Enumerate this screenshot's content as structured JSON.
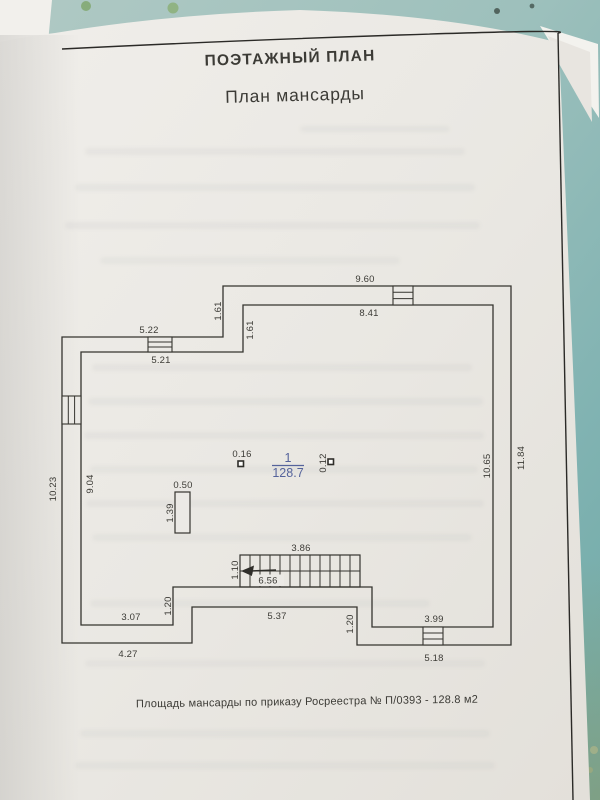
{
  "page": {
    "title": "ПОЭТАЖНЫЙ ПЛАН",
    "subtitle": "План мансарды",
    "caption": "Площадь мансарды по приказу Росреестра № П/0393 - 128.8 м2"
  },
  "plan": {
    "room": {
      "number": "1",
      "area": "128.7"
    },
    "dim": {
      "top_outer": "9.60",
      "top_inner": "8.41",
      "step_top_outer": "1.61",
      "step_top_inner": "1.61",
      "left_top_outer": "5.22",
      "left_top_inner": "5.21",
      "left_outer": "10.23",
      "left_inner": "9.04",
      "right_inner": "10.65",
      "right_outer": "11.84",
      "flue_width": "0.50",
      "flue_height": "1.39",
      "column_left": "0.16",
      "column_right": "0.12",
      "stairs_width": "3.86",
      "stairs_depth": "1.10",
      "stairs_run": "6.56",
      "step_bottom_left": "1.20",
      "step_bottom_right": "1.20",
      "bottom_left_inner": "3.07",
      "bottom_left_outer": "4.27",
      "bottom_center": "5.37",
      "bottom_right_inner": "3.99",
      "bottom_right_outer": "5.18"
    }
  }
}
